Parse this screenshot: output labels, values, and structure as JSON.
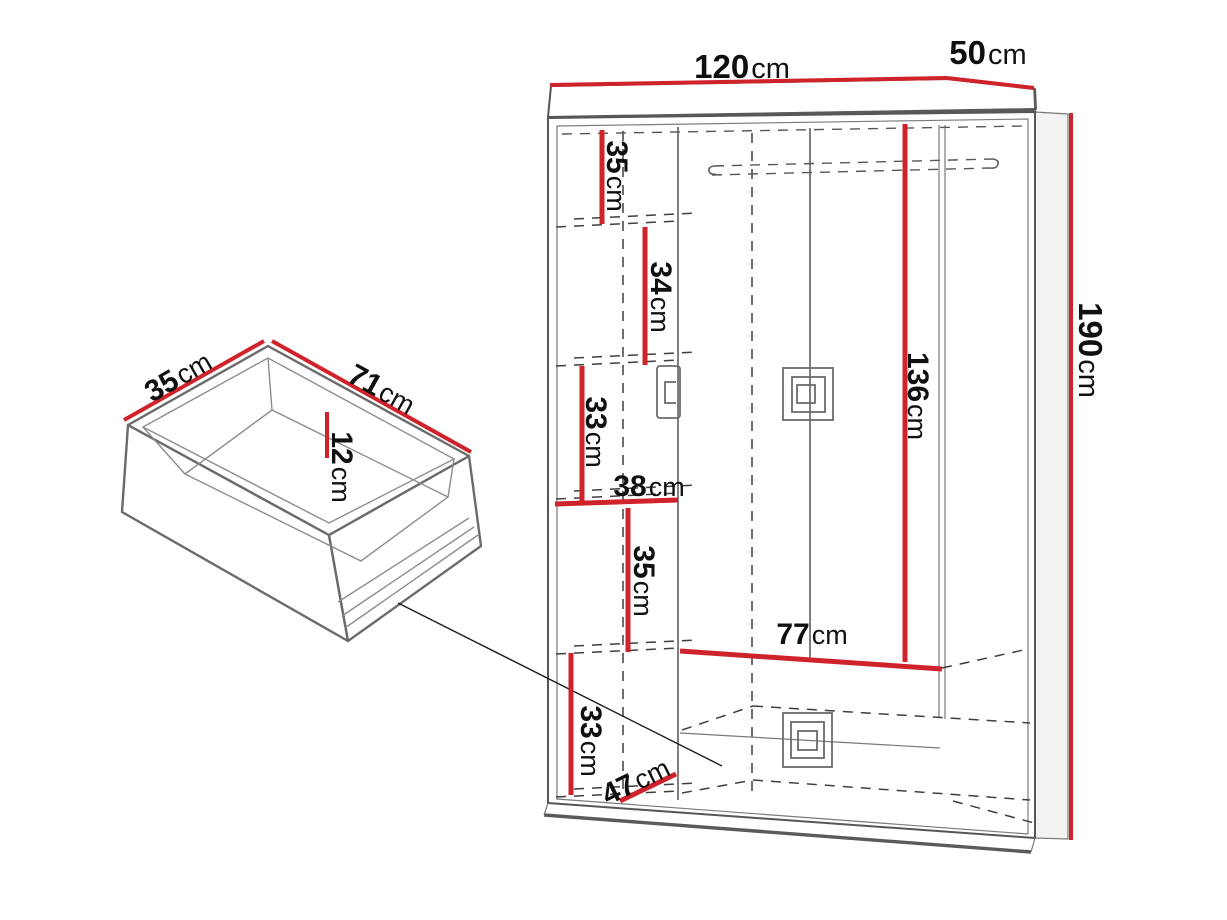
{
  "colors": {
    "background": "#ffffff",
    "dimension_red": "#cf232b",
    "outline_gray": "#565656",
    "dashed_gray": "#3f3f3f",
    "text_black": "#101010"
  },
  "wardrobe": {
    "overall": {
      "width": {
        "value": "120",
        "unit": "cm"
      },
      "depth": {
        "value": "50",
        "unit": "cm"
      },
      "height": {
        "value": "190",
        "unit": "cm"
      }
    },
    "interior": {
      "hanging_section_height": {
        "value": "136",
        "unit": "cm"
      },
      "hanging_section_width": {
        "value": "77",
        "unit": "cm"
      },
      "shelf_column_width": {
        "value": "38",
        "unit": "cm"
      },
      "shelf_sections_top_to_bottom": [
        {
          "value": "35",
          "unit": "cm"
        },
        {
          "value": "34",
          "unit": "cm"
        },
        {
          "value": "33",
          "unit": "cm"
        },
        {
          "value": "35",
          "unit": "cm"
        },
        {
          "value": "33",
          "unit": "cm"
        }
      ],
      "bottom_shelf_depth": {
        "value": "47",
        "unit": "cm"
      }
    }
  },
  "drawer": {
    "depth": {
      "value": "35",
      "unit": "cm"
    },
    "width": {
      "value": "71",
      "unit": "cm"
    },
    "height": {
      "value": "12",
      "unit": "cm"
    }
  }
}
